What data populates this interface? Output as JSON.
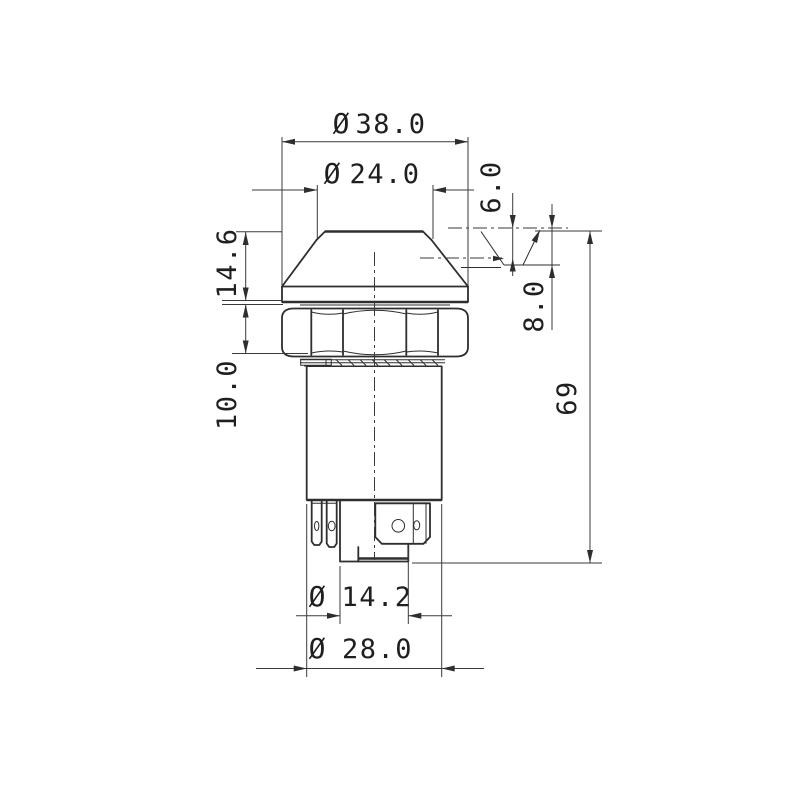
{
  "drawing": {
    "kind": "technical-dimension-drawing",
    "subject": "push-button-switch-side-view",
    "colors": {
      "line": "#2e2e2e",
      "dimension": "#3a3a3a",
      "background": "#ffffff"
    },
    "dims": {
      "dia38": {
        "symbol": "Ø",
        "value": "38.0"
      },
      "dia24": {
        "symbol": "Ø",
        "value": "24.0"
      },
      "h146": {
        "value": "14.6"
      },
      "h100": {
        "value": "10.0"
      },
      "d60": {
        "value": "6.0"
      },
      "d80": {
        "value": "8.0"
      },
      "len69": {
        "value": "69"
      },
      "dia142": {
        "symbol": "Ø",
        "value": "14.2"
      },
      "dia280": {
        "symbol": "Ø",
        "value": "28.0"
      }
    }
  }
}
